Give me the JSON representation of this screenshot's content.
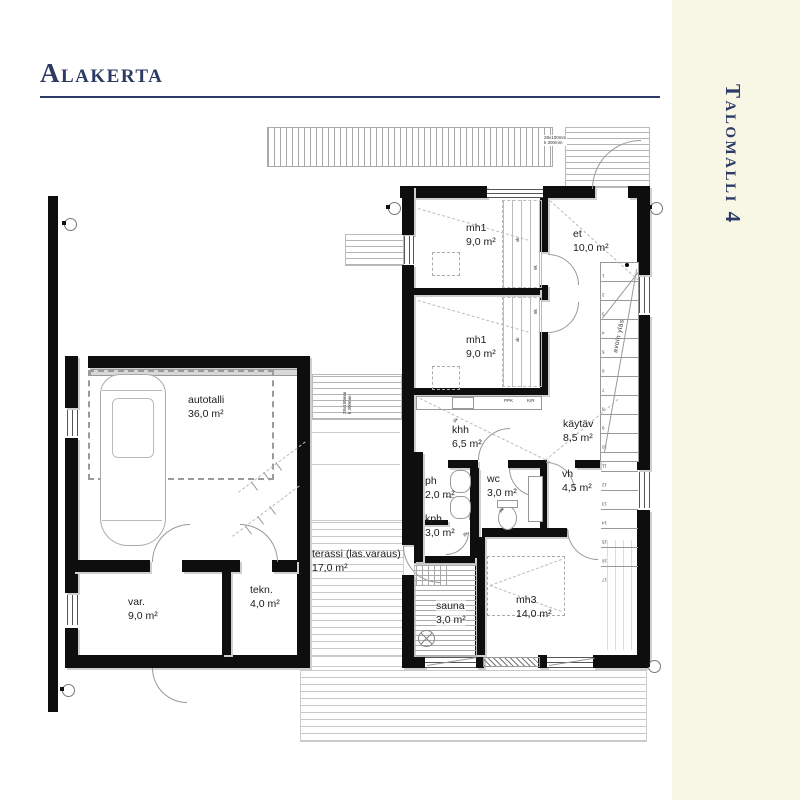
{
  "header": {
    "title": "Alakerta",
    "side_label": "Talomalli 4"
  },
  "colors": {
    "accent_navy": "#2c3a64",
    "sidebar_cream": "#f8f6e4",
    "wall_black": "#0e0e0e",
    "line_gray": "#9a9a9a"
  },
  "rooms": [
    {
      "name": "autotalli",
      "area": "36,0 m²"
    },
    {
      "name": "var.",
      "area": "9,0 m²"
    },
    {
      "name": "tekn.",
      "area": "4,0 m²"
    },
    {
      "name": "terassi (las.varaus)",
      "area": "17,0 m²"
    },
    {
      "name": "mh1",
      "area": "9,0 m²"
    },
    {
      "name": "mh1",
      "area": "9,0 m²"
    },
    {
      "name": "et",
      "area": "10,0 m²"
    },
    {
      "name": "khh",
      "area": "6,5 m²"
    },
    {
      "name": "käytäv",
      "area": "8,5 m²"
    },
    {
      "name": "ph",
      "area": "2,0 m²"
    },
    {
      "name": "wc",
      "area": "3,0 m²"
    },
    {
      "name": "kph",
      "area": "3,0 m²"
    },
    {
      "name": "vh",
      "area": "4,5 m²"
    },
    {
      "name": "sauna",
      "area": "3,0 m²"
    },
    {
      "name": "mh3",
      "area": "14,0 m²"
    }
  ],
  "annotations": {
    "deck_spec_line1": "28x100mm",
    "deck_spec_line2": "k 300mm",
    "stair_note": "avoin yläs",
    "stair_steps": [
      "1",
      "2",
      "3",
      "4",
      "5",
      "6",
      "7",
      "8",
      "9",
      "10",
      "11",
      "12",
      "13",
      "14",
      "15",
      "16",
      "17"
    ],
    "appliance_ppk": "PPK",
    "appliance_kr": "K/R",
    "wardrobe_mark": "sk",
    "door_mark_a": "9k",
    "door_mark_b": "8k"
  }
}
